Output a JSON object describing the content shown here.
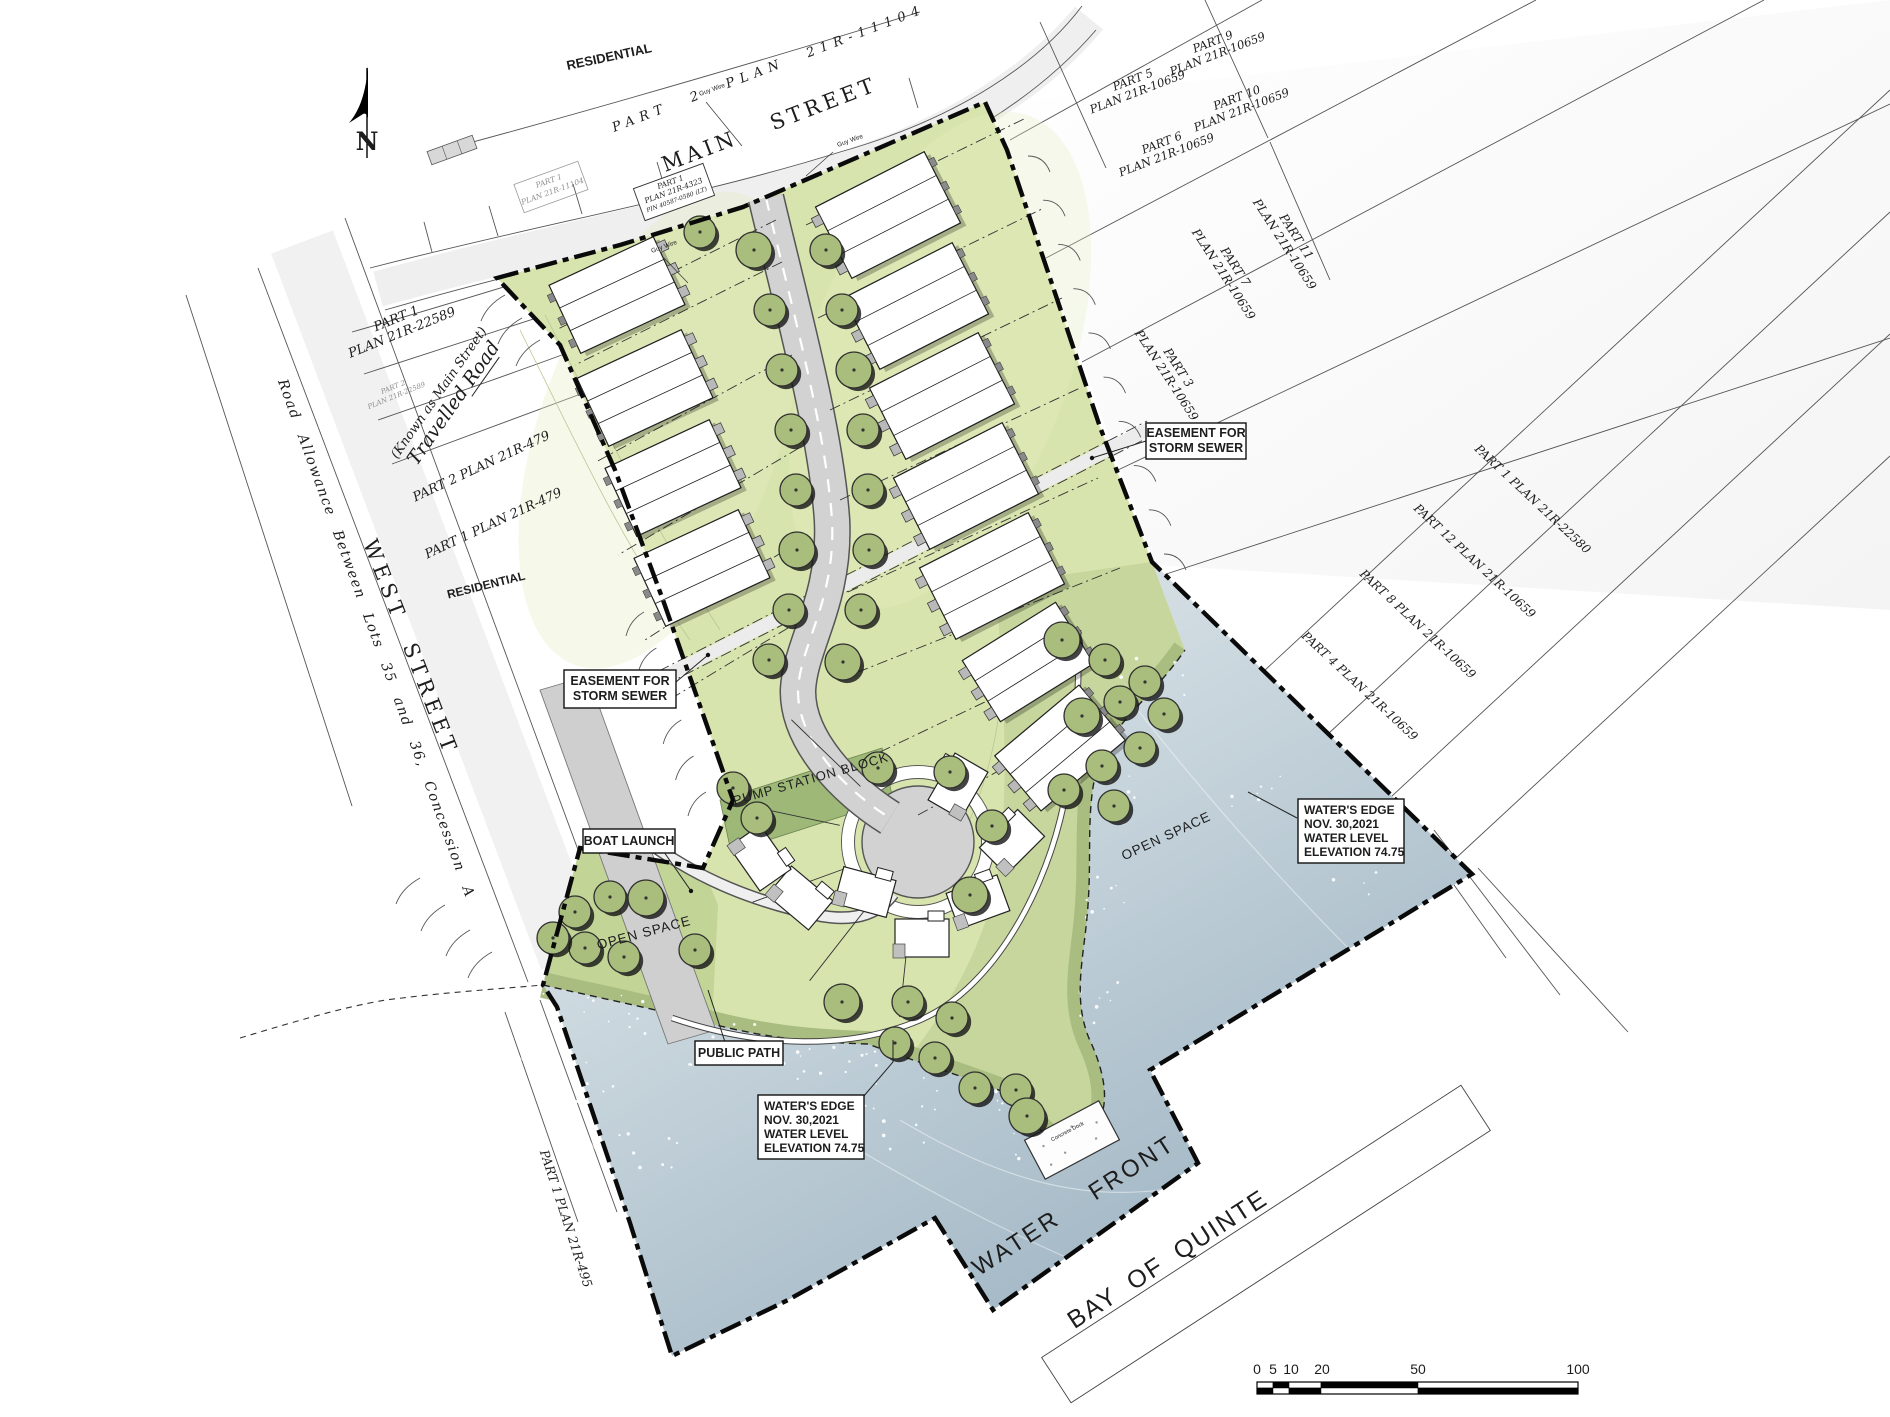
{
  "document": {
    "type": "Waterfront residential site plan"
  },
  "compass": {
    "north": "N"
  },
  "streets": {
    "main": "MAIN STREET",
    "west": "WEST STREET",
    "travelled_line1": "(Known as Main Street)",
    "travelled_line2": "Travelled Road",
    "road_allowance": "Road Allowance Between Lots 35 and 36, Concession A",
    "water_front": "WATER FRONT",
    "bay": "BAY OF QUINTE"
  },
  "zones": {
    "residential_top": "RESIDENTIAL",
    "residential_west": "RESIDENTIAL",
    "open_space_west": "OPEN SPACE",
    "open_space_east": "OPEN SPACE",
    "pump_station": "PUMP STATION BLOCK"
  },
  "parcels": {
    "p2_11104": "PART 2   PLAN 21R-11104",
    "p1_11104": {
      "l1": "PART 1",
      "l2": "PLAN 21R-11104"
    },
    "p1_4323": {
      "l1": "PART 1",
      "l2": "PLAN 21R-4323",
      "l3": "PIN 40587-0580 (LT)"
    },
    "p5": {
      "l1": "PART 5",
      "l2": "PLAN 21R-10659"
    },
    "p9": {
      "l1": "PART 9",
      "l2": "PLAN 21R-10659"
    },
    "p6": {
      "l1": "PART 6",
      "l2": "PLAN 21R-10659"
    },
    "p10": {
      "l1": "PART 10",
      "l2": "PLAN 21R-10659"
    },
    "p11": {
      "l1": "PART 11",
      "l2": "PLAN 21R-10659"
    },
    "p7": {
      "l1": "PART 7",
      "l2": "PLAN 21R-10659"
    },
    "p3": {
      "l1": "PART 3",
      "l2": "PLAN 21R-10659"
    },
    "p1_22580": "PART 1 PLAN 21R-22580",
    "p12": "PART 12 PLAN 21R-10659",
    "p8": "PART 8 PLAN 21R-10659",
    "p4": "PART 4 PLAN 21R-10659",
    "p1_22589": {
      "l1": "PART 1",
      "l2": "PLAN 21R-22589"
    },
    "p2_22589": {
      "l1": "PART 2",
      "l2": "PLAN 21R-22589"
    },
    "p2_479": "PART 2 PLAN 21R-479",
    "p1_479": "PART 1 PLAN 21R-479",
    "p1_495": "PART 1 PLAN 21R-495"
  },
  "callouts": {
    "easement": {
      "l1": "EASEMENT FOR",
      "l2": "STORM SEWER"
    },
    "boat_launch": "BOAT LAUNCH",
    "public_path": "PUBLIC PATH",
    "waters_edge": {
      "l1": "WATER'S EDGE",
      "l2": "NOV. 30,2021",
      "l3": "WATER LEVEL",
      "l4": "ELEVATION 74.75"
    },
    "concrete_dock": "Concrete Dock",
    "guy_wire": "Guy Wire"
  },
  "scalebar": {
    "labels": [
      "0",
      "5",
      "10",
      "20",
      "50",
      "100"
    ]
  },
  "colors": {
    "site_green": "#d8e4ae",
    "open_space_green": "#c3d497",
    "bank_olive": "#a9bd80",
    "pump_green": "#9db877",
    "tree_green": "#a9bd7d",
    "water_deep": "#9db3c2",
    "water_light": "#eef2f3",
    "road_gray": "#d2d2d2",
    "boundary_black": "#111111"
  }
}
